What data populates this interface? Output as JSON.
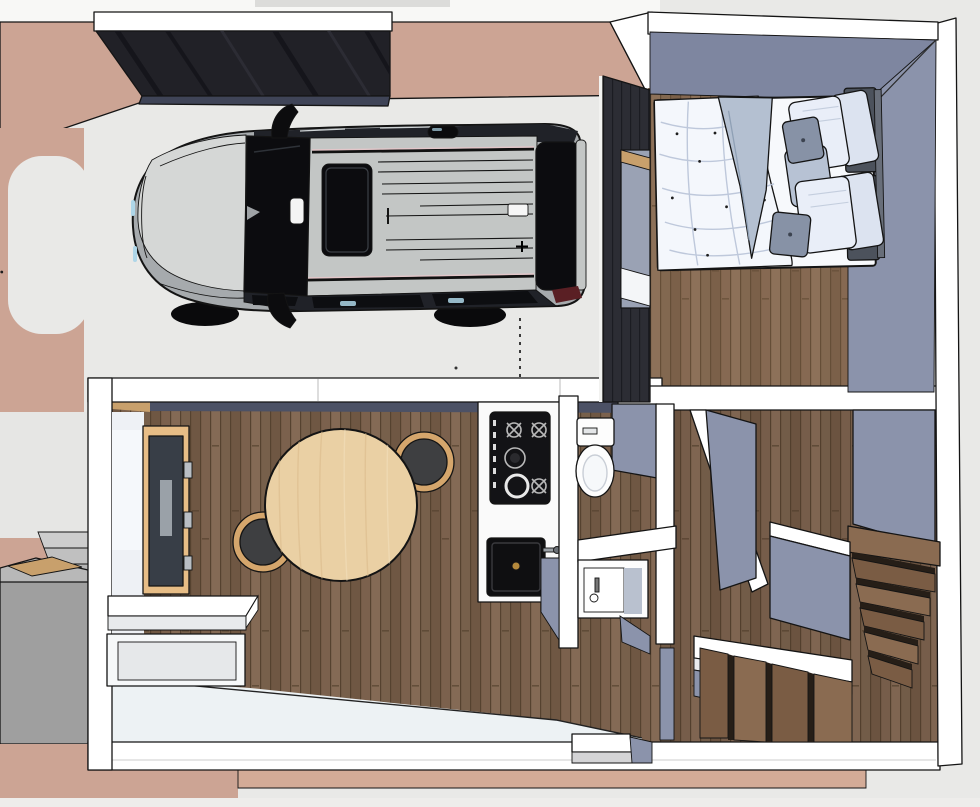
{
  "scene": {
    "type": "3d-floorplan-render",
    "view": "top-down-perspective",
    "subject": "tiny house model with carport, bedroom, living-dining room, kitchen, bathroom and winder staircase"
  },
  "colors": {
    "bg": "#e9e9e7",
    "topStrip": "#f8f8f6",
    "terracotta": "#cca494",
    "terracottaSoft": "#d3ab97",
    "pathGray": "#e6e6e4",
    "canopy": "#212127",
    "canopyStripe": "#15151b",
    "canopyEdge": "#3f4457",
    "outline": "#141414",
    "wallWhite": "#ffffff",
    "wallFaceLight": "#eef1f5",
    "innerShadow": "#4c5165",
    "blueWall": "#8b93ab",
    "blueWallDark": "#7e86a0",
    "darkWall": "#2c2d34",
    "darkWallLine": "#1b1c22",
    "plankA": "#7b614d",
    "plankB": "#846a55",
    "plankC": "#6f5743",
    "plankD": "#77604b",
    "plankLine": "#55422f",
    "entryFloor": "#edf2f4",
    "tableWood": "#ead0a4",
    "tableWoodDark": "#d9b989",
    "chairDark": "#3e3f41",
    "chairRim": "#d5a66c",
    "counterWhite": "#fafafa",
    "cooktopBlack": "#131316",
    "sinkBlack": "#0f0f11",
    "brass": "#b5893c",
    "fixtureShade": "#b9c1cf",
    "duvet": "#f4f7fc",
    "duvetLine": "#b9c4d8",
    "blanket": "#b4c0d1",
    "pillowWhite": "#e9eef8",
    "pillowBack": "#dce3f0",
    "pillowGray": "#b7c2d4",
    "cushionGray": "#8792a6",
    "headboard": "#4c525c",
    "headboardLight": "#686e79",
    "carMid": "#a6aaad",
    "carHood": "#d5d7d6",
    "carRoof": "#c3c6c5",
    "carDark": "#202228",
    "carGlass": "#0c0c0f",
    "railPink": "#e3c6c9",
    "glintBlue": "#aed6e8",
    "tailRed": "#5a1f24",
    "stairWoodA": "#8a6b51",
    "stairWoodB": "#7a5c44",
    "riser": "#261e17",
    "grayBox": "#9f9f9f",
    "grayBoxTop": "#b8b8b8",
    "stepGray1": "#cdcdcd",
    "stepGray2": "#c0c0c0",
    "stepGray3": "#b4b4b4",
    "sillTan": "#c8a06c"
  },
  "rooms": [
    {
      "name": "carport",
      "objects": [
        "suv-car",
        "canopy-roof",
        "parking-guide-dashed-line",
        "driveway"
      ]
    },
    {
      "name": "bedroom",
      "objects": [
        "double-bed",
        "duvet",
        "folded-blanket",
        "pillows",
        "cushions",
        "headboard",
        "window",
        "dark-clad-wall"
      ]
    },
    {
      "name": "living-dining-room",
      "objects": [
        "round-dining-table",
        "chair",
        "chair",
        "tv-panel",
        "wall-shelf",
        "low-cabinet"
      ]
    },
    {
      "name": "kitchen",
      "objects": [
        "counter",
        "gas-cooktop",
        "black-sink",
        "faucet"
      ]
    },
    {
      "name": "bathroom",
      "objects": [
        "toilet",
        "vanity-sink",
        "partition-wall"
      ]
    },
    {
      "name": "stairwell",
      "objects": [
        "upper-flight",
        "winder-lower-flight",
        "landing",
        "guard-wall",
        "bench-wall"
      ]
    },
    {
      "name": "exterior",
      "objects": [
        "terracotta-patio",
        "walkway",
        "entry-steps",
        "planter-box",
        "threshold-step"
      ]
    }
  ]
}
